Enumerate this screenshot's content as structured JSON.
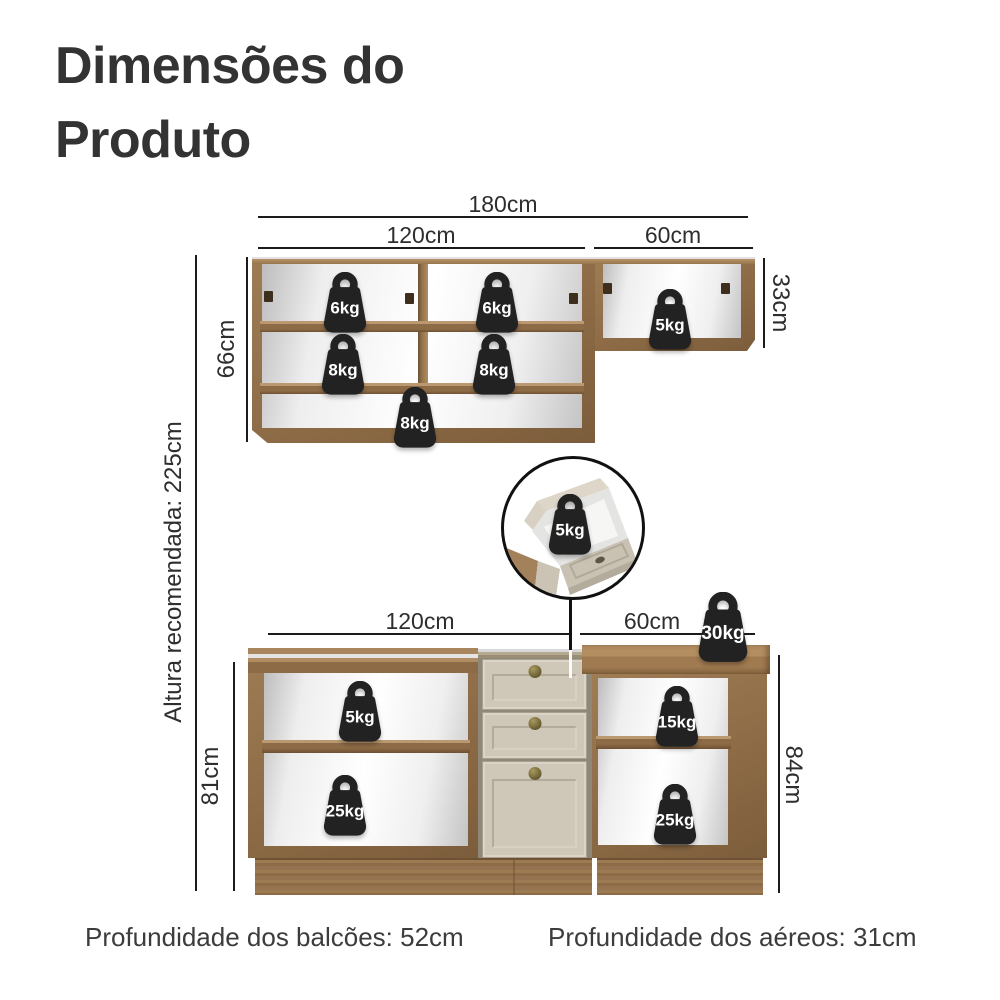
{
  "title": {
    "line1": "Dimensões do",
    "line2": "Produto"
  },
  "upper_unit": {
    "total_width": "180cm",
    "left_width": "120cm",
    "right_width": "60cm",
    "left_height": "66cm",
    "right_height": "33cm",
    "weights": {
      "shelf_top_left": "6kg",
      "shelf_top_right": "6kg",
      "shelf_mid_left": "8kg",
      "shelf_mid_right": "8kg",
      "shelf_bottom": "8kg",
      "right_cabinet": "5kg"
    }
  },
  "drawer_detail": {
    "weight": "5kg"
  },
  "lower_unit": {
    "left_width": "120cm",
    "right_width": "60cm",
    "left_height": "81cm",
    "right_height": "84cm",
    "weights": {
      "countertop": "30kg",
      "left_shelf_top": "5kg",
      "left_shelf_bottom": "25kg",
      "right_shelf_top": "15kg",
      "right_shelf_bottom": "25kg"
    }
  },
  "recommended_height_label": "Altura recomendada: 225cm",
  "footer": {
    "counters_depth": "Profundidade dos balcões: 52cm",
    "aerials_depth": "Profundidade dos aéreos: 31cm"
  },
  "colors": {
    "wood": "#8d6b46",
    "wood_light": "#b08c62",
    "wood_dark": "#6e5233",
    "drawer_front": "#cfc7b8",
    "badge": "#222222",
    "dimension_line": "#1b1b1b",
    "text": "#333333"
  }
}
